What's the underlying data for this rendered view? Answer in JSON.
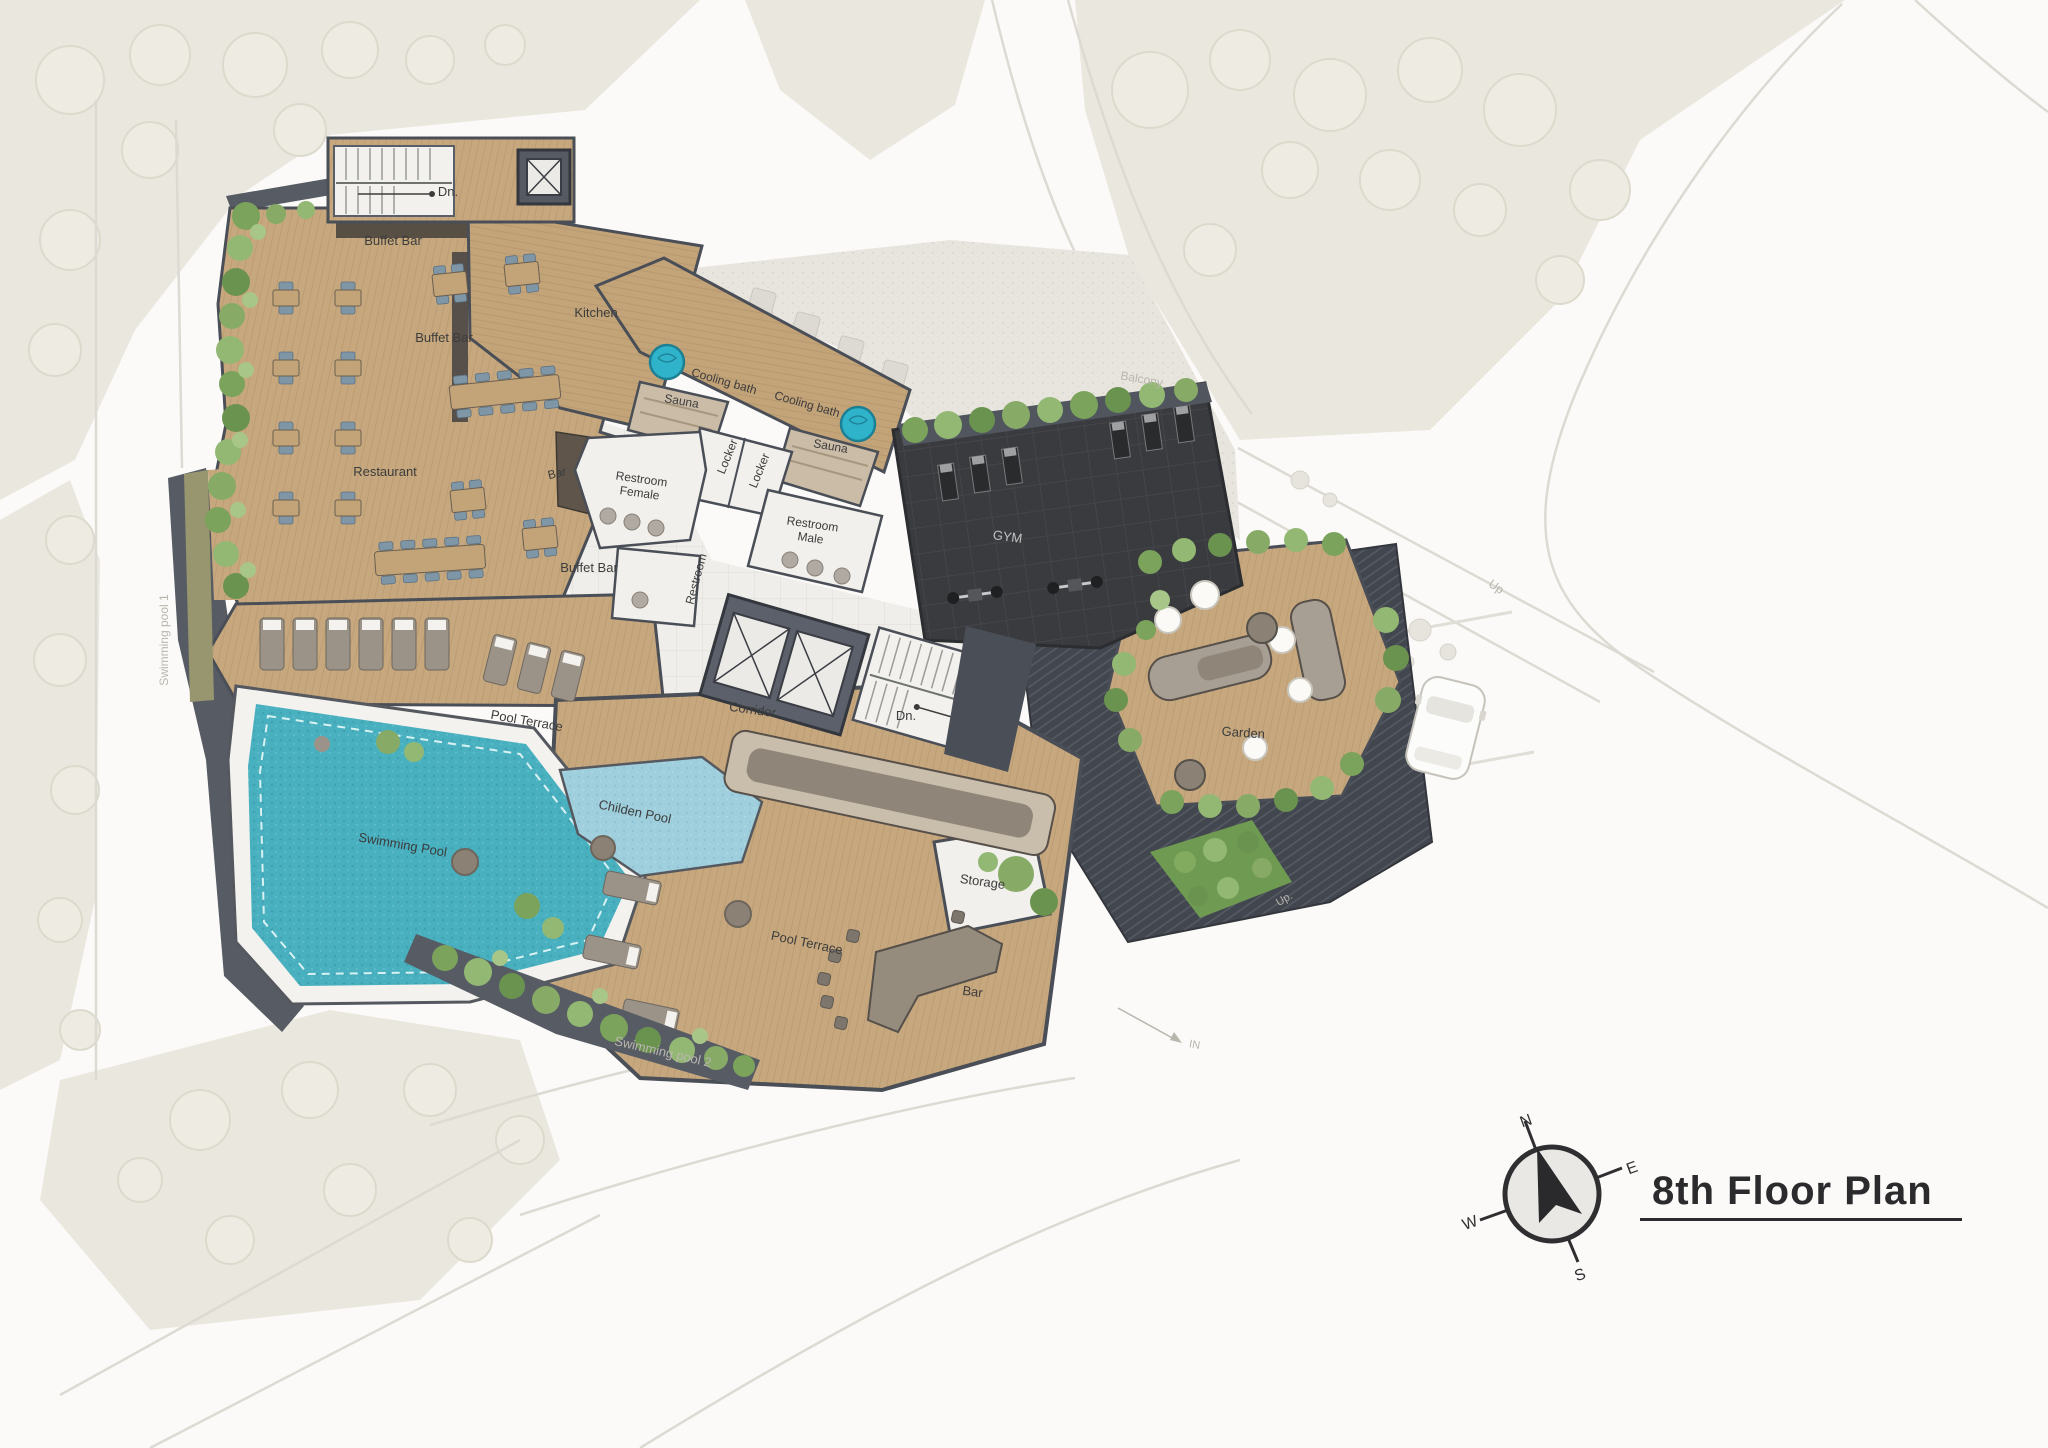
{
  "title": {
    "text": "8th Floor Plan"
  },
  "compass": {
    "n": "N",
    "e": "E",
    "s": "S",
    "w": "W"
  },
  "colors": {
    "wood_deck": "#c7a87e",
    "dark_wall": "#4a4e57",
    "gym_floor": "#3a3b3e",
    "pool_water": "#49b0bf",
    "children_pool": "#9fcfdd",
    "cooling_tub": "#2fb3ca",
    "greenery": "#7ba35c",
    "site_landscape": "#eae8de",
    "tile_floor": "#efeeea",
    "label_dark": "#3c3c3c",
    "label_faint": "#b9b6ae",
    "title_ink": "#2b2b2d"
  },
  "labels": [
    {
      "id": "dn-top",
      "text": "Dn.",
      "x": 448,
      "y": 196,
      "rot": 0,
      "size": 13
    },
    {
      "id": "buffet-bar-top",
      "text": "Buffet Bar",
      "x": 393,
      "y": 245,
      "rot": 0,
      "size": 13
    },
    {
      "id": "buffet-bar-mid",
      "text": "Buffet Bar",
      "x": 444,
      "y": 342,
      "rot": 0,
      "size": 13
    },
    {
      "id": "kitchen",
      "text": "Kitchen",
      "x": 596,
      "y": 317,
      "rot": 0,
      "size": 13
    },
    {
      "id": "restaurant",
      "text": "Restaurant",
      "x": 385,
      "y": 476,
      "rot": 0,
      "size": 13
    },
    {
      "id": "bar-restaurant",
      "text": "Bar",
      "x": 558,
      "y": 477,
      "rot": -14,
      "size": 12
    },
    {
      "id": "buffet-bar-bottom",
      "text": "Buffet Bar",
      "x": 589,
      "y": 572,
      "rot": 0,
      "size": 13
    },
    {
      "id": "cooling-bath-left",
      "text": "Cooling bath",
      "x": 723,
      "y": 385,
      "rot": 16,
      "size": 12
    },
    {
      "id": "cooling-bath-right",
      "text": "Cooling bath",
      "x": 806,
      "y": 408,
      "rot": 16,
      "size": 12
    },
    {
      "id": "sauna-left",
      "text": "Sauna",
      "x": 681,
      "y": 405,
      "rot": 10,
      "size": 12
    },
    {
      "id": "sauna-right",
      "text": "Sauna",
      "x": 830,
      "y": 450,
      "rot": 10,
      "size": 12
    },
    {
      "id": "locker-left",
      "text": "Locker",
      "x": 731,
      "y": 458,
      "rot": -68,
      "size": 12
    },
    {
      "id": "locker-right",
      "text": "Locker",
      "x": 763,
      "y": 472,
      "rot": -68,
      "size": 12
    },
    {
      "id": "restroom-female",
      "lines": [
        "Restroom",
        "Female"
      ],
      "x": 641,
      "y": 483,
      "rot": 8,
      "size": 12
    },
    {
      "id": "restroom-male",
      "lines": [
        "Restroom",
        "Male"
      ],
      "x": 812,
      "y": 528,
      "rot": 8,
      "size": 12
    },
    {
      "id": "restroom-center",
      "text": "Restroom",
      "x": 700,
      "y": 580,
      "rot": -75,
      "size": 12
    },
    {
      "id": "gym",
      "text": "GYM",
      "x": 1007,
      "y": 541,
      "rot": 8,
      "size": 13,
      "tone": "light"
    },
    {
      "id": "corridor",
      "text": "Corridor",
      "x": 752,
      "y": 714,
      "rot": 8,
      "size": 13
    },
    {
      "id": "dn-center",
      "text": "Dn.",
      "x": 906,
      "y": 720,
      "rot": 0,
      "size": 13
    },
    {
      "id": "garden",
      "text": "Garden",
      "x": 1243,
      "y": 737,
      "rot": 4,
      "size": 13
    },
    {
      "id": "pool-terrace-upper",
      "text": "Pool Terrace",
      "x": 526,
      "y": 725,
      "rot": 10,
      "size": 13
    },
    {
      "id": "childen-pool",
      "text": "Childen Pool",
      "x": 634,
      "y": 816,
      "rot": 12,
      "size": 13
    },
    {
      "id": "swimming-pool",
      "text": "Swimming Pool",
      "x": 402,
      "y": 849,
      "rot": 10,
      "size": 13
    },
    {
      "id": "pool-terrace-lower",
      "text": "Pool Terrace",
      "x": 806,
      "y": 947,
      "rot": 12,
      "size": 13
    },
    {
      "id": "storage",
      "text": "Storage",
      "x": 982,
      "y": 886,
      "rot": 8,
      "size": 13
    },
    {
      "id": "bar-pool",
      "text": "Bar",
      "x": 972,
      "y": 996,
      "rot": 8,
      "size": 13
    },
    {
      "id": "balcony",
      "text": "Balcony",
      "x": 1141,
      "y": 383,
      "rot": 10,
      "size": 12,
      "tone": "faint"
    },
    {
      "id": "swimming-pool-1",
      "text": "Swimming pool 1",
      "x": 168,
      "y": 640,
      "rot": -90,
      "size": 12,
      "tone": "faint"
    },
    {
      "id": "swimming-pool-2",
      "text": "Swimming pool 2",
      "x": 662,
      "y": 1056,
      "rot": 13,
      "size": 13,
      "tone": "faint"
    },
    {
      "id": "up-ramp",
      "text": "Up",
      "x": 1494,
      "y": 590,
      "rot": 35,
      "size": 12,
      "tone": "faint"
    },
    {
      "id": "up-small",
      "text": "Up.",
      "x": 1286,
      "y": 902,
      "rot": -30,
      "size": 11,
      "tone": "faint"
    },
    {
      "id": "in-entry",
      "text": "IN",
      "x": 1194,
      "y": 1048,
      "rot": 10,
      "size": 11,
      "tone": "faint"
    }
  ]
}
